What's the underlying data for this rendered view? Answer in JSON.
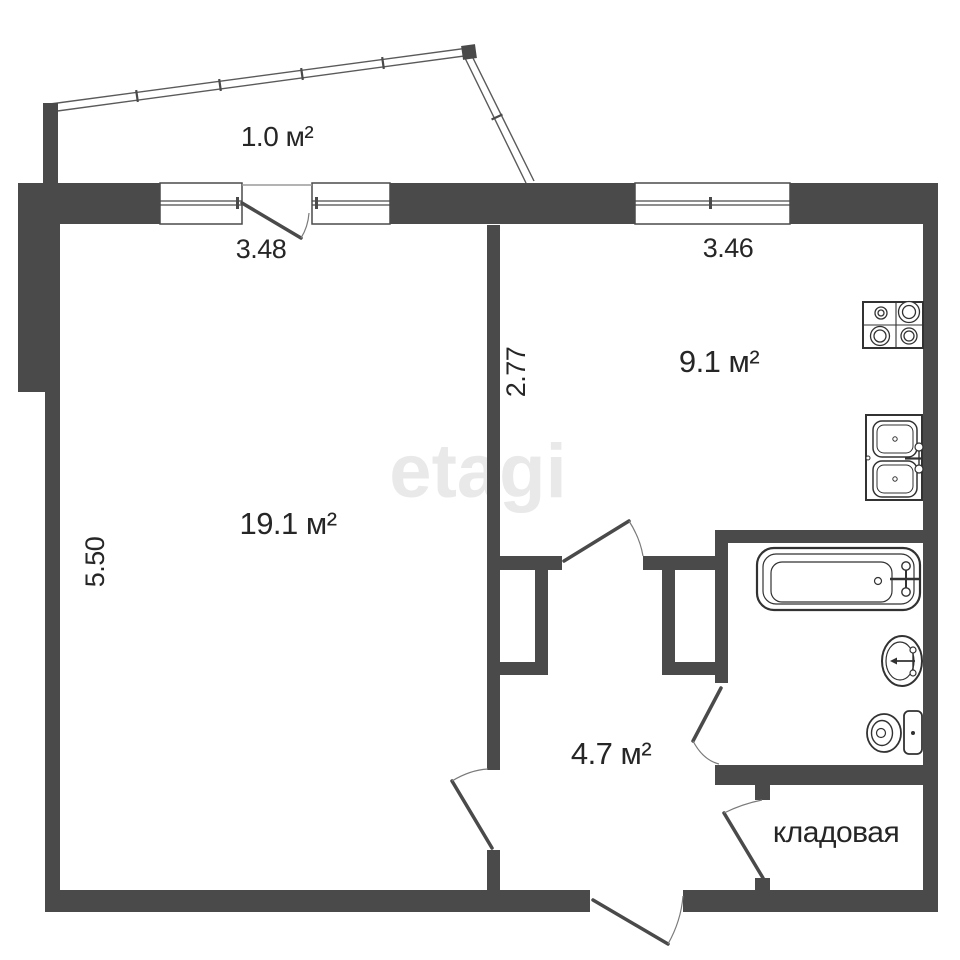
{
  "watermark": "etagi",
  "room_labels": {
    "balcony": "1.0 м²",
    "living": "19.1 м²",
    "kitchen": "9.1 м²",
    "hallway": "4.7 м²",
    "storage": "кладовая"
  },
  "dimensions": {
    "living_width": "3.48",
    "kitchen_width": "3.46",
    "kitchen_depth": "2.77",
    "living_depth": "5.50"
  },
  "fixtures": [
    "bathtub",
    "washbasin",
    "toilet",
    "stove-4-burner",
    "double-kitchen-sink"
  ],
  "colors": {
    "wall": "#4a4a4a",
    "fixture_line": "#323232",
    "text": "#262626",
    "watermark": "#e9e9e9",
    "background": "#ffffff"
  }
}
